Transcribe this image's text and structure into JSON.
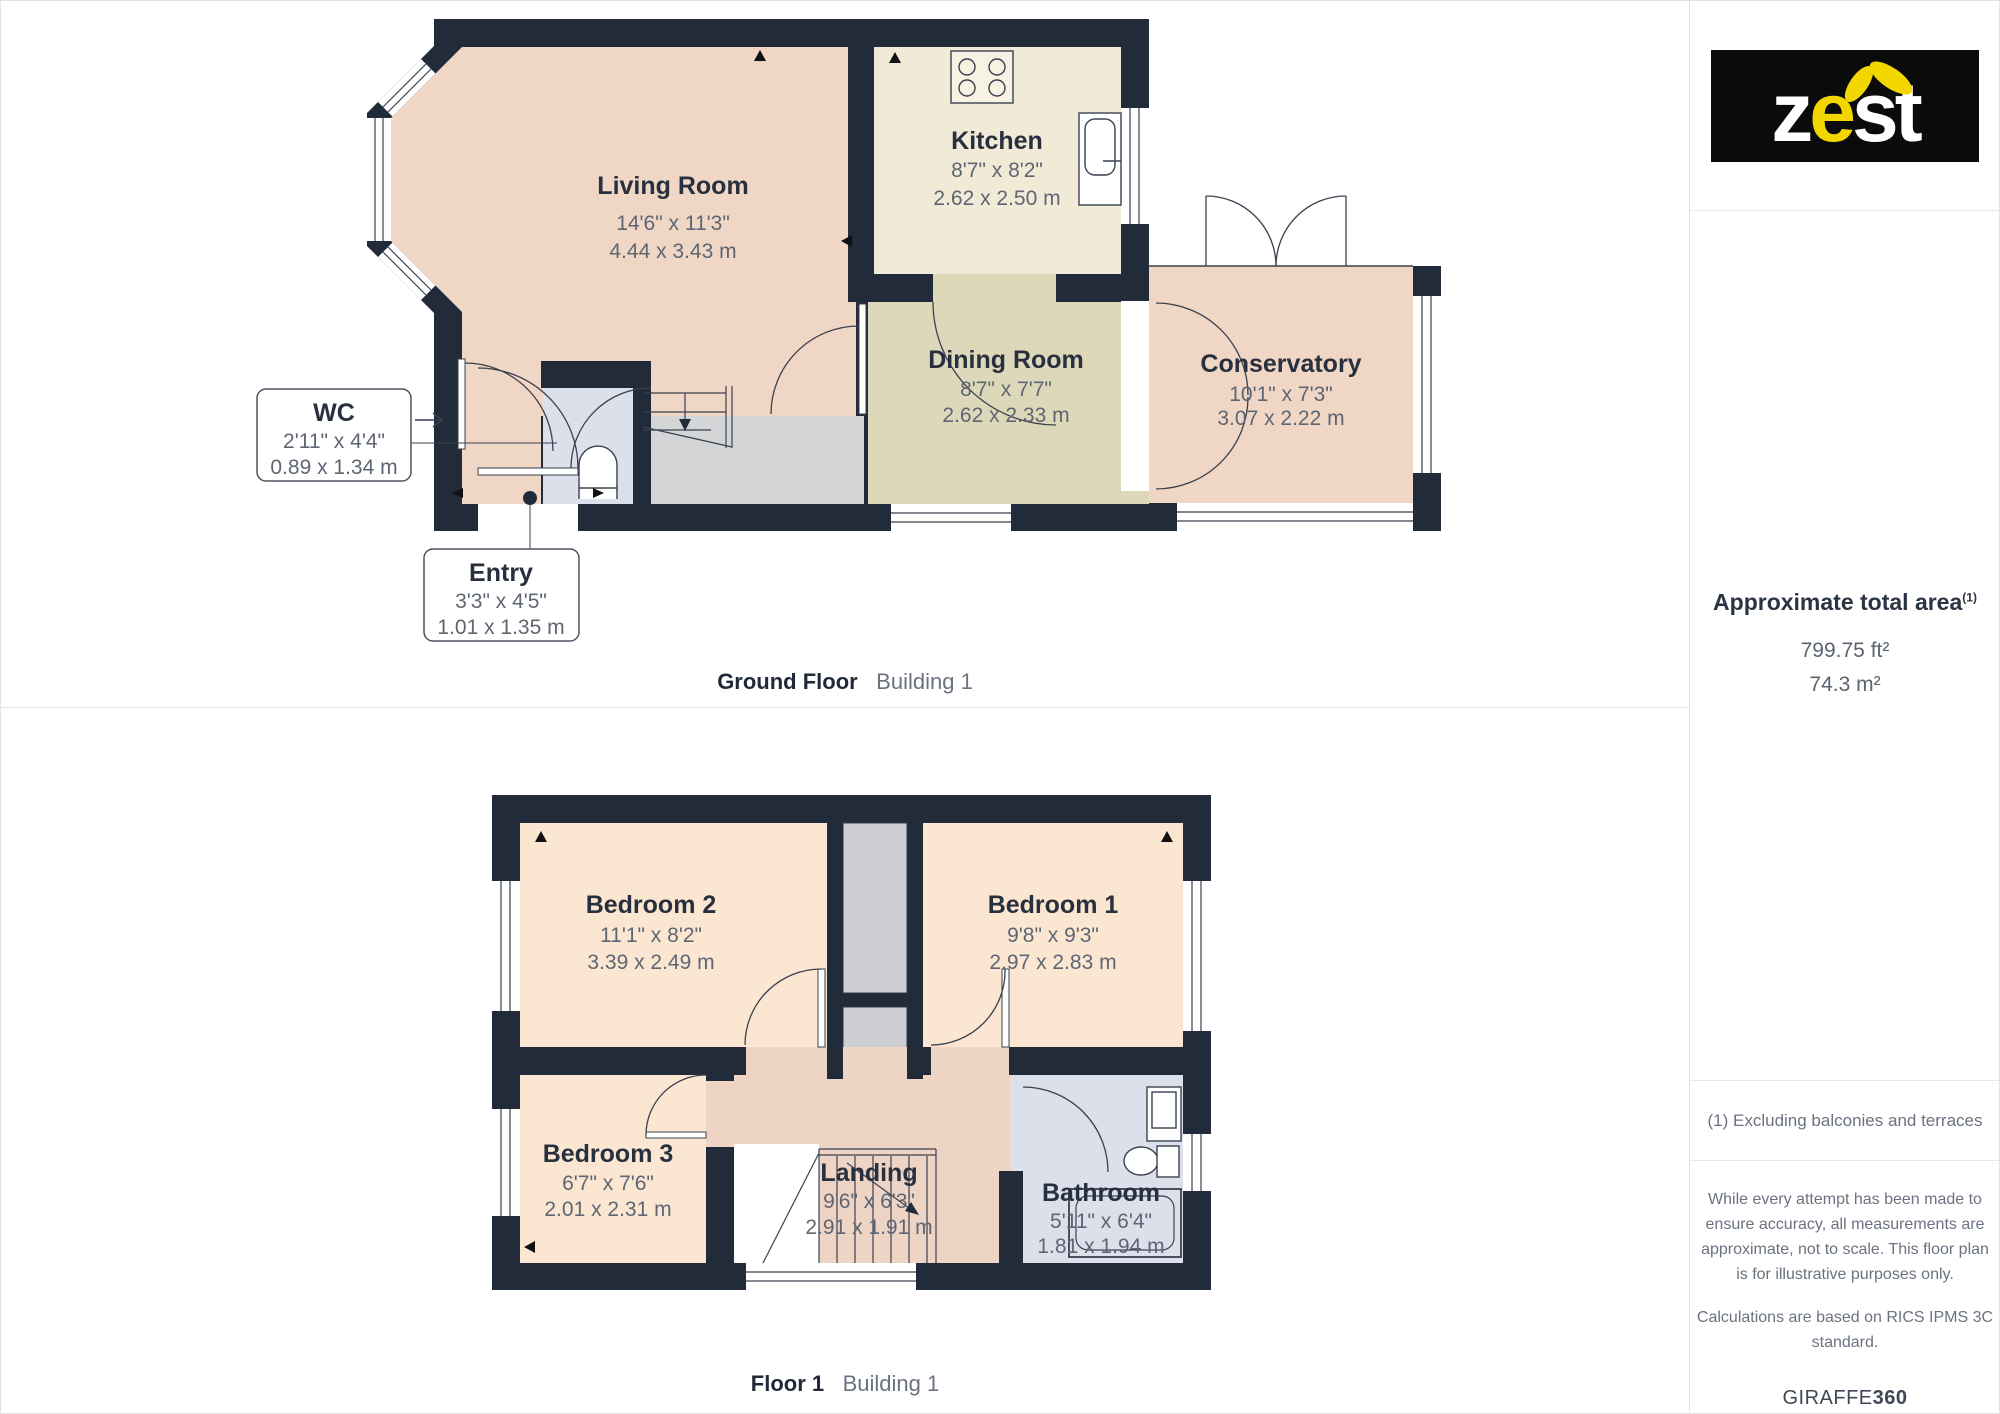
{
  "ground_floor": {
    "caption": {
      "bold": "Ground Floor",
      "light": "Building 1"
    },
    "rooms": {
      "living": {
        "name": "Living Room",
        "imperial": "14'6\" x 11'3\"",
        "metric": "4.44 x 3.43 m"
      },
      "kitchen": {
        "name": "Kitchen",
        "imperial": "8'7\" x 8'2\"",
        "metric": "2.62 x 2.50 m"
      },
      "dining": {
        "name": "Dining Room",
        "imperial": "8'7\" x 7'7\"",
        "metric": "2.62 x 2.33 m"
      },
      "conservatory": {
        "name": "Conservatory",
        "imperial": "10'1\" x 7'3\"",
        "metric": "3.07 x 2.22 m"
      },
      "wc": {
        "name": "WC",
        "imperial": "2'11\" x 4'4\"",
        "metric": "0.89 x 1.34 m"
      },
      "entry": {
        "name": "Entry",
        "imperial": "3'3\" x 4'5\"",
        "metric": "1.01 x 1.35 m"
      }
    }
  },
  "first_floor": {
    "caption": {
      "bold": "Floor 1",
      "light": "Building 1"
    },
    "rooms": {
      "bedroom2": {
        "name": "Bedroom 2",
        "imperial": "11'1\" x 8'2\"",
        "metric": "3.39 x 2.49 m"
      },
      "bedroom1": {
        "name": "Bedroom 1",
        "imperial": "9'8\" x 9'3\"",
        "metric": "2.97 x 2.83 m"
      },
      "bedroom3": {
        "name": "Bedroom 3",
        "imperial": "6'7\" x 7'6\"",
        "metric": "2.01 x 2.31 m"
      },
      "landing": {
        "name": "Landing",
        "imperial": "9'6\" x 6'3\"",
        "metric": "2.91 x 1.91 m"
      },
      "bathroom": {
        "name": "Bathroom",
        "imperial": "5'11\" x 6'4\"",
        "metric": "1.81 x 1.94 m"
      }
    }
  },
  "sidebar": {
    "logo": {
      "part1": "z",
      "part2": "e",
      "part3": "st"
    },
    "area": {
      "title": "Approximate total area",
      "footnote_mark": "(1)",
      "imperial": "799.75 ft²",
      "metric": "74.3 m²"
    },
    "footnote": "(1) Excluding balconies and terraces",
    "disclaimer_1": "While every attempt has been made to ensure accuracy, all measurements are approximate, not to scale. This floor plan is for illustrative purposes only.",
    "disclaimer_2": "Calculations are based on RICS IPMS 3C standard.",
    "brand": {
      "name": "GIRAFFE",
      "suffix": "360"
    }
  },
  "colors": {
    "wall": "#222b3a",
    "living_pink": "#f0d6c5",
    "bedroom_peach": "#fbe7d1",
    "landing_pink": "#eed4c4",
    "kitchen_cream": "#f0ead6",
    "dining_tan": "#ded8ba",
    "bath_blue": "#dce0eb",
    "hall_grey": "#d4d5d6",
    "logo_yellow": "#f2d600",
    "logo_black": "#0b0b0b"
  }
}
